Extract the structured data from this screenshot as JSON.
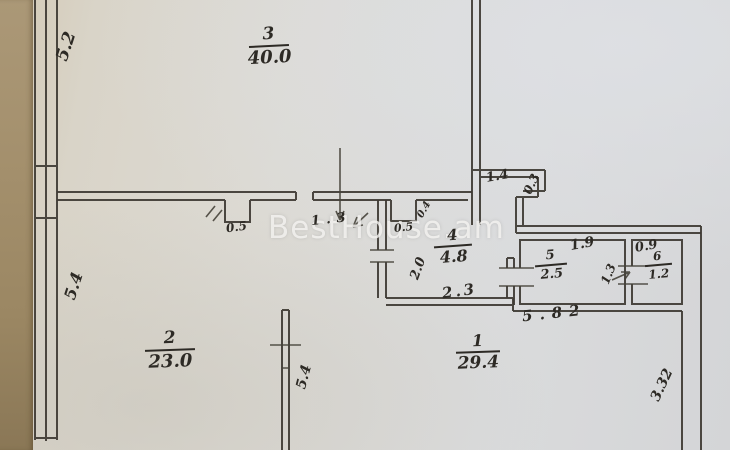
{
  "watermark": {
    "text": "BestHouse.am"
  },
  "rooms": [
    {
      "number": "1",
      "area": "29.4"
    },
    {
      "number": "2",
      "area": "23.0"
    },
    {
      "number": "3",
      "area": "40.0"
    },
    {
      "number": "4",
      "area": "4.8"
    },
    {
      "number": "5",
      "area": "2.5"
    },
    {
      "number": "6",
      "area": "1.2"
    }
  ],
  "dimensions": {
    "left_wall_upper": "5.2",
    "left_wall_lower": "5.4",
    "niche_width": "0.5",
    "wall_opening": "1.3",
    "notch_length": "1.4",
    "notch_depth": "0.3",
    "closet_depth": "0.4",
    "closet_width": "0.5",
    "room4_depth": "2.0",
    "room4_width": "2.3",
    "room5_width": "1.9",
    "room6_width": "0.9",
    "room5_depth": "1.3",
    "wing_length": "5.82",
    "divider_wall": "5.4",
    "right_wall": "3.32"
  }
}
